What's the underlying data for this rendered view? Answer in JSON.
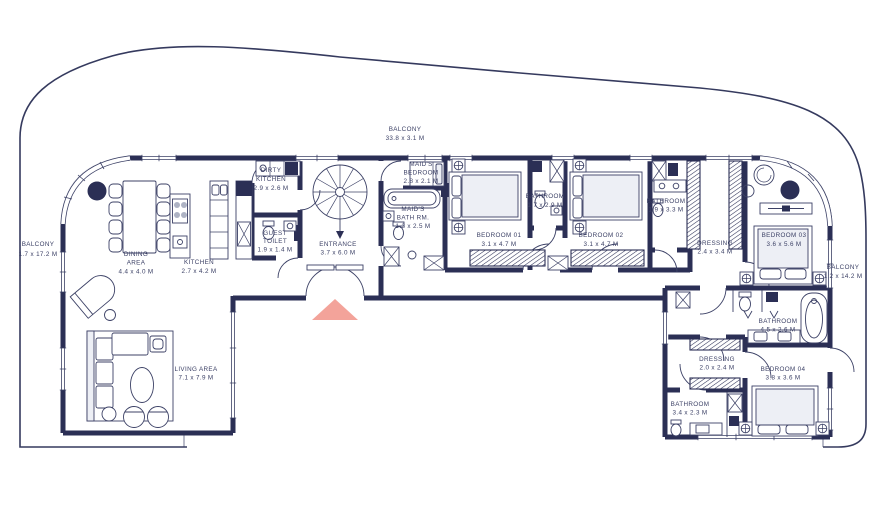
{
  "colors": {
    "wall": "#2b2f55",
    "line": "#3c4166",
    "accent": "#f2998f",
    "bed_fill": "#edeff5",
    "background": "#ffffff"
  },
  "rooms": {
    "balcony_left": {
      "name": "BALCONY",
      "dims": "1.7 x 17.2 M"
    },
    "dining": {
      "name1": "DINING",
      "name2": "AREA",
      "dims": "4.4 x 4.0 M"
    },
    "kitchen": {
      "name": "KITCHEN",
      "dims": "2.7 x 4.2 M"
    },
    "dirty_kitchen": {
      "name1": "DIRTY",
      "name2": "KITCHEN",
      "dims": "2.9 x 2.6 M"
    },
    "guest_toilet": {
      "name1": "GUEST",
      "name2": "TOILET",
      "dims": "1.9 x 1.4 M"
    },
    "entrance": {
      "name": "ENTRANCE",
      "dims": "3.7 x 6.0 M"
    },
    "balcony_top": {
      "name": "BALCONY",
      "dims": "33.8 x 3.1 M"
    },
    "maids_bedroom": {
      "name1": "MAID'S",
      "name2": "BEDROOM",
      "dims": "2.8 x 2.1 M"
    },
    "maids_bath": {
      "name1": "MAID'S",
      "name2": "BATH RM.",
      "dims": "1.3 x 2.5 M"
    },
    "bedroom_01": {
      "name": "BEDROOM 01",
      "dims": "3.1 x 4.7 M"
    },
    "bathroom_shared": {
      "name": "BATHROOM",
      "dims": "1.7 x 2.9 M"
    },
    "bedroom_02": {
      "name": "BEDROOM 02",
      "dims": "3.1 x 4.7 M"
    },
    "bathroom_02": {
      "name": "BATHROOM",
      "dims": "1.9 x 3.3 M"
    },
    "dressing_03": {
      "name": "DRESSING",
      "dims": "2.4 x 3.4 M"
    },
    "bedroom_03": {
      "name": "BEDROOM 03",
      "dims": "3.6 x 5.6 M"
    },
    "balcony_right": {
      "name": "BALCONY",
      "dims": "1.2 x 14.2 M"
    },
    "bathroom_master": {
      "name": "BATHROOM",
      "dims": "4.5 x 2.6 M"
    },
    "dressing_04": {
      "name": "DRESSING",
      "dims": "2.0 x 2.4 M"
    },
    "bedroom_04": {
      "name": "BEDROOM 04",
      "dims": "3.8 x 3.6 M"
    },
    "bathroom_04": {
      "name": "BATHROOM",
      "dims": "3.4 x 2.3 M"
    },
    "living": {
      "name": "LIVING AREA",
      "dims": "7.1 x 7.9 M"
    }
  }
}
